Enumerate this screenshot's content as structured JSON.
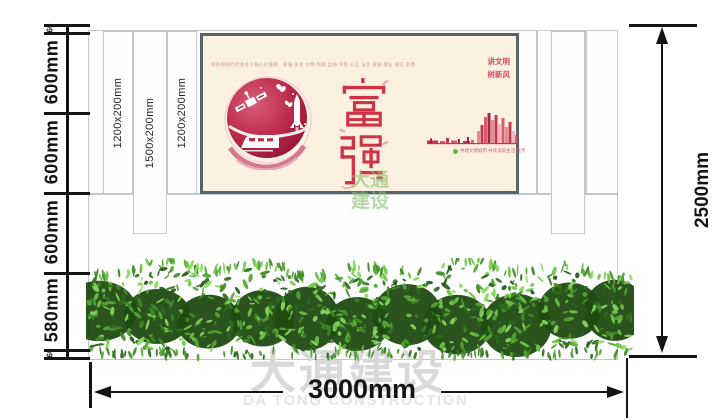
{
  "watermark": {
    "cn": "大通建设",
    "en": "DA TONG CONSTRUCTION"
  },
  "logo_watermark": {
    "line1": "大通",
    "line2": "建设"
  },
  "dimensions": {
    "left_segments": [
      "60",
      "600mm",
      "600mm",
      "600mm",
      "580mm",
      "60"
    ],
    "right_total": "2500mm",
    "bottom_total": "3000mm"
  },
  "pillars": [
    {
      "label": "1200x200mm"
    },
    {
      "label": "1500x200mm"
    },
    {
      "label": "1200x200mm"
    }
  ],
  "poster": {
    "top_slogan": "培育和践行社会主义核心价值观　富强 民主 文明 和谐 自由 平等 公正 法治 爱国 敬业 诚信 友善",
    "corner_slogan": [
      "讲文明",
      "树新风"
    ],
    "main_text": "富强",
    "footer_note": "共建文明城市 共享美好生活 宣传",
    "colors": {
      "poster_bg": "#fcf1e0",
      "accent_red": "#cf3346",
      "circle_red": "#b02342"
    },
    "skyline_bars": [
      [
        0,
        11,
        2.5,
        "#c23650"
      ],
      [
        3,
        2,
        4.5,
        "#a52540"
      ],
      [
        13,
        5,
        2,
        "#d85a6e"
      ],
      [
        19,
        3,
        5,
        "#c23650"
      ],
      [
        24,
        6,
        2.5,
        "#d85a6e"
      ],
      [
        31,
        2,
        4,
        "#a52540"
      ],
      [
        36,
        7,
        2,
        "#c23650"
      ],
      [
        40,
        2,
        6,
        "#a52540"
      ],
      [
        44,
        3,
        3,
        "#d85a6e"
      ],
      [
        50,
        3,
        12,
        "#e58a97"
      ],
      [
        53.5,
        3,
        18,
        "#c23650"
      ],
      [
        57,
        3,
        26,
        "#d85a6e"
      ],
      [
        60.5,
        3,
        30,
        "#a52540"
      ],
      [
        64,
        3,
        23,
        "#e58a97"
      ],
      [
        67.5,
        3,
        28,
        "#c23650"
      ],
      [
        71,
        3,
        19,
        "#f2b8c0"
      ],
      [
        74.5,
        3,
        25,
        "#d85a6e"
      ],
      [
        78,
        3,
        16,
        "#e58a97"
      ],
      [
        81.5,
        3,
        21,
        "#c23650"
      ],
      [
        85,
        3,
        12,
        "#f2b8c0"
      ],
      [
        88,
        2,
        8,
        "#d85a6e"
      ]
    ]
  },
  "hedge": {
    "palette": [
      "#1f4a12",
      "#2e6b1c",
      "#3f8a27",
      "#55a634",
      "#6fc24a",
      "#8ad95f",
      "#24571a"
    ]
  }
}
